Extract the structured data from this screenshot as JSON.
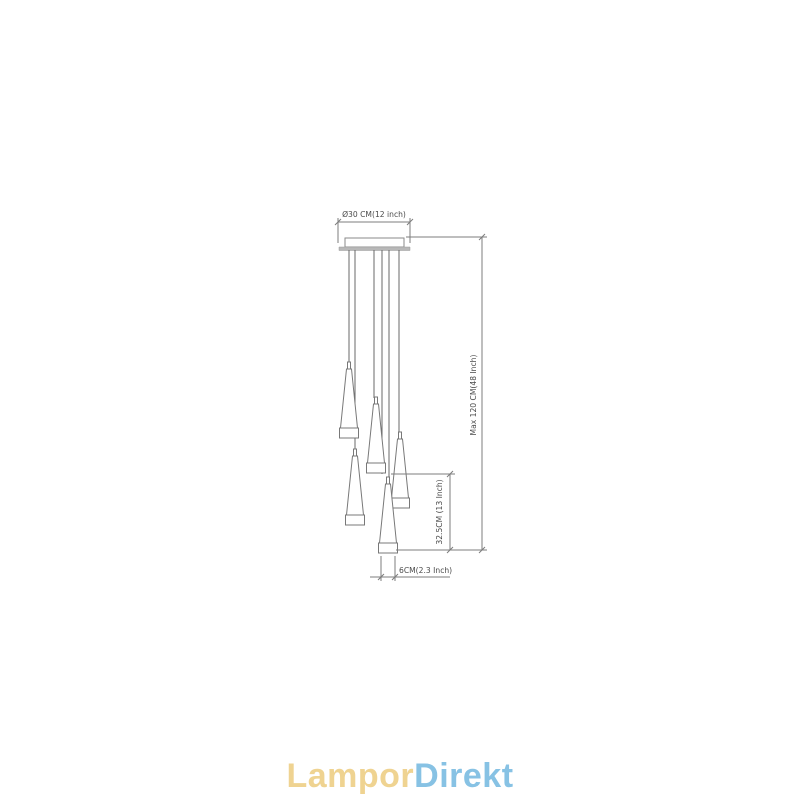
{
  "drawing": {
    "dim_canopy_diameter": "Ø30 CM(12 inch)",
    "dim_max_height": "Max 120 CM(48 Inch)",
    "dim_cone_length": "32.5CM (13 Inch)",
    "dim_cone_width": "6CM(2.3 Inch)"
  },
  "logo": {
    "part1": "Lampor",
    "part2": "Direkt",
    "part1_color": "#EFD391",
    "part2_color": "#87C2E4"
  },
  "colors": {
    "line": "#7d7d7d",
    "wire": "#6a6a6a",
    "label": "#4a4a4a",
    "plate_fill": "#b8b8b8"
  }
}
